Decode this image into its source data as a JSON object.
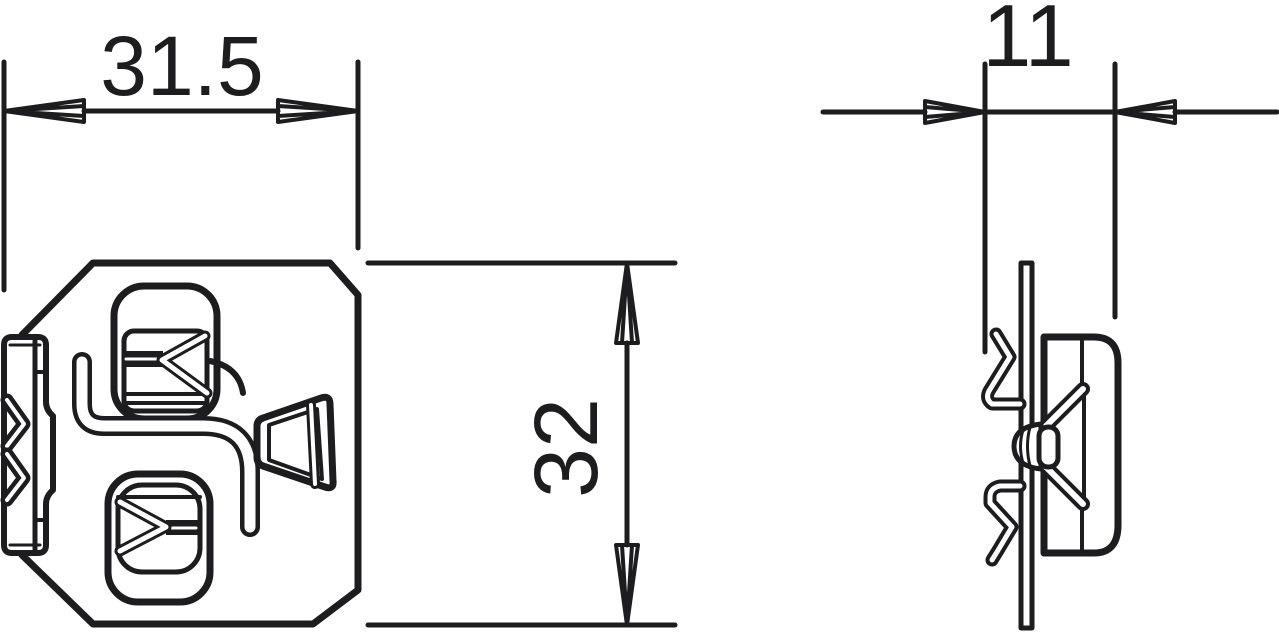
{
  "drawing": {
    "type": "technical-dimension-drawing",
    "background": "#ffffff",
    "line_color": "#1d1d1f",
    "dimensions": {
      "front_width": "31.5",
      "front_height": "32",
      "side_depth": "11"
    }
  }
}
